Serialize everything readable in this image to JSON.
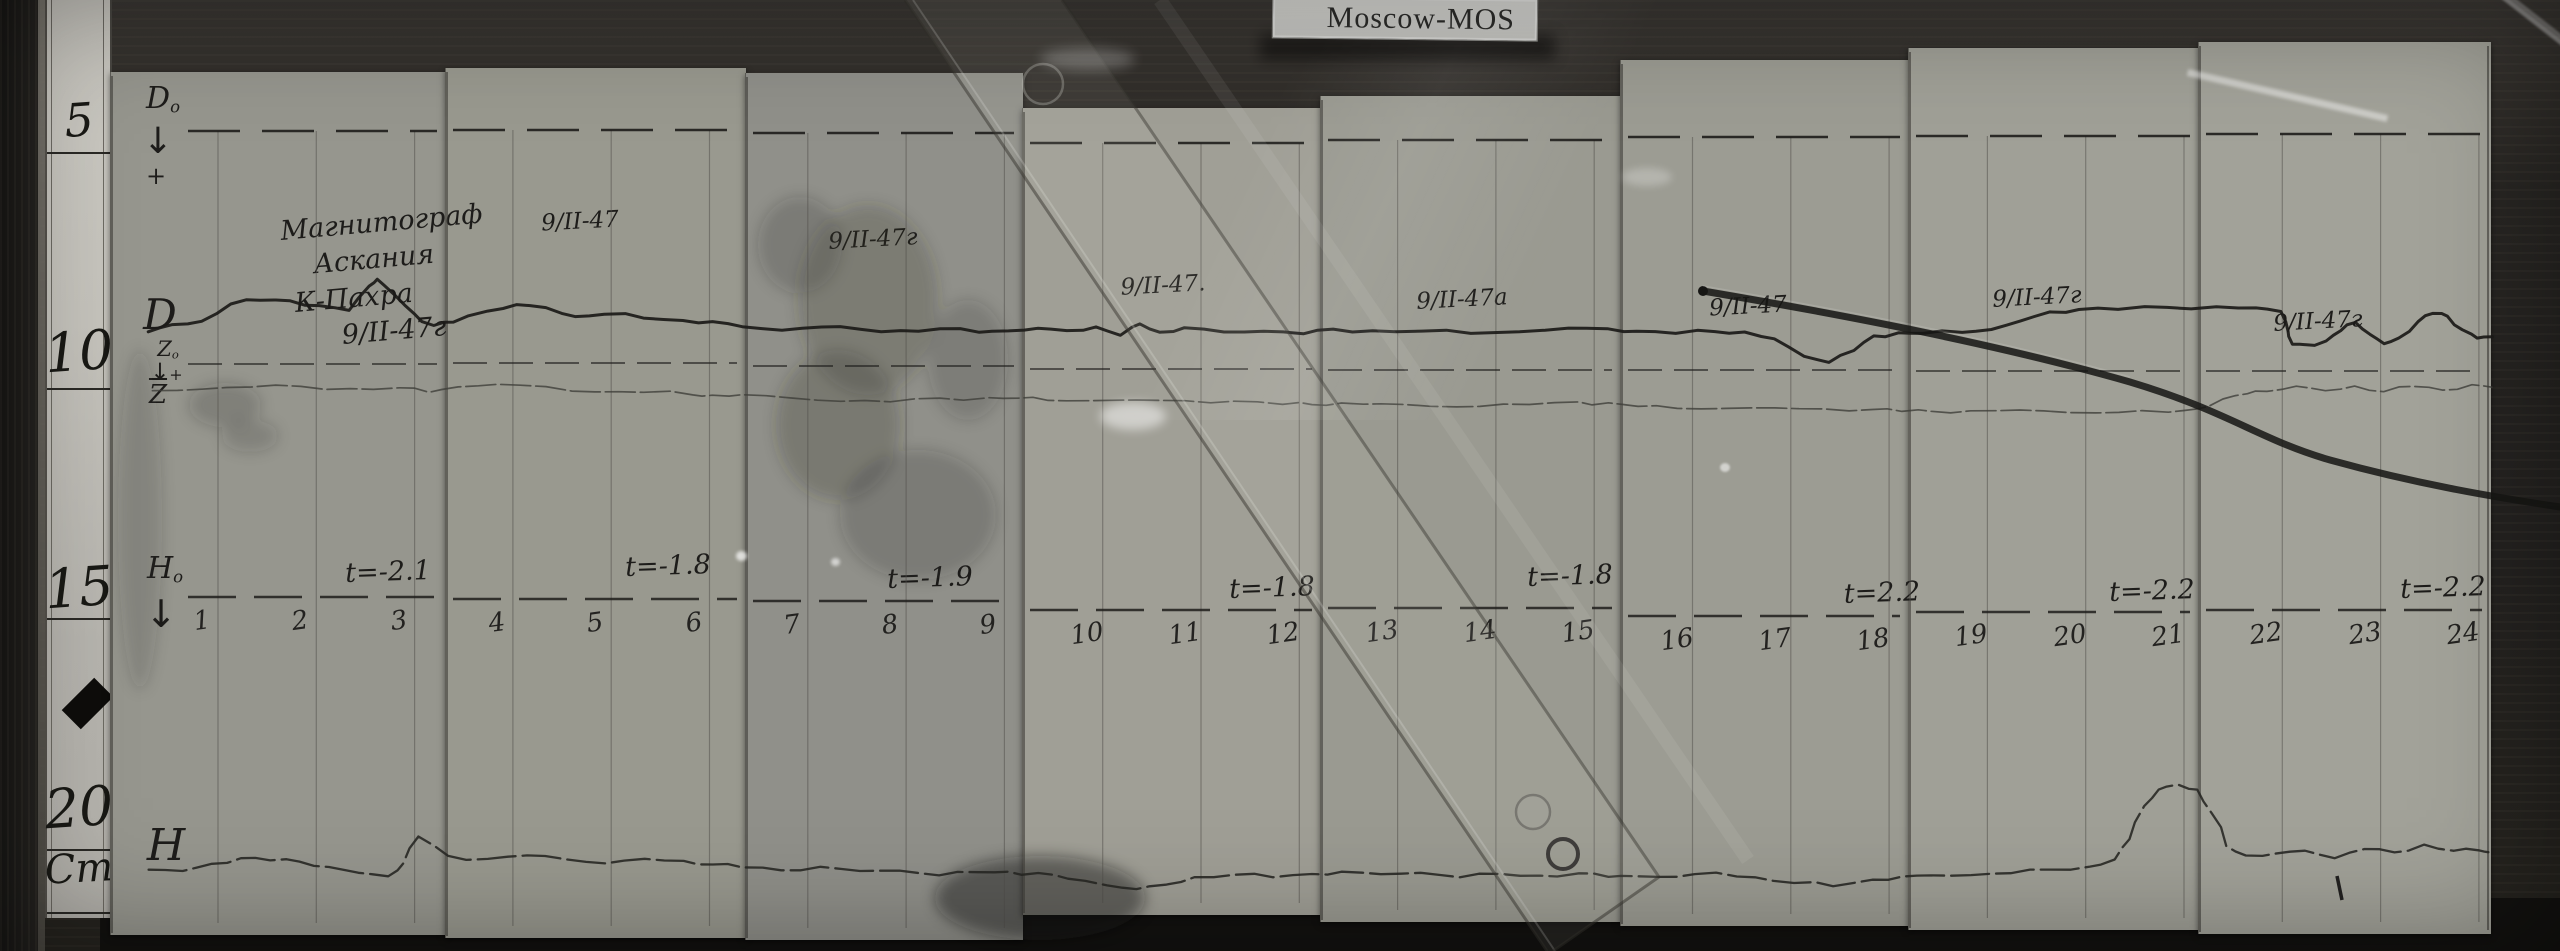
{
  "station_label": "Moscow-MOS",
  "ruler": {
    "marks": [
      "5",
      "10",
      "15",
      "20"
    ],
    "unit": "Cm"
  },
  "header_block": {
    "lines": [
      "Магнитограф",
      "Аскания",
      "К-Пахра",
      "9/II-47г"
    ]
  },
  "trace_labels": {
    "d_baseline": {
      "main": "D",
      "sub": "o"
    },
    "d_arrow": "↓",
    "d_plus": "+",
    "d": "D",
    "z_baseline": {
      "main": "Z",
      "sub": "o"
    },
    "z_arrow": "↓",
    "z_plus": "+",
    "z": "Z",
    "h_baseline": {
      "main": "H",
      "sub": "o"
    },
    "h_arrow": "↓",
    "h": "H"
  },
  "panels": [
    {
      "date": "",
      "t": "t=-2.1",
      "hours": [
        "1",
        "2",
        "3"
      ]
    },
    {
      "date": "9/II-47",
      "t": "t=-1.8",
      "hours": [
        "4",
        "5",
        "6"
      ]
    },
    {
      "date": "9/II-47г",
      "t": "t=-1.9",
      "hours": [
        "7",
        "8",
        "9"
      ]
    },
    {
      "date": "9/II-47.",
      "t": "t=-1.8",
      "hours": [
        "10",
        "11",
        "12"
      ]
    },
    {
      "date": "9/II-47а",
      "t": "t=-1.8",
      "hours": [
        "13",
        "14",
        "15"
      ]
    },
    {
      "date": "9/II-47",
      "t": "t=2.2",
      "hours": [
        "16",
        "17",
        "18"
      ]
    },
    {
      "date": "9/II-47г",
      "t": "t=-2.2",
      "hours": [
        "19",
        "20",
        "21"
      ]
    },
    {
      "date": "9/II-47г",
      "t": "t=-2.2",
      "hours": [
        "22",
        "23",
        "24"
      ]
    }
  ],
  "colors": {
    "paper": "#9b9b93",
    "ink": "#1d1c1a",
    "wood": "#262421",
    "card": "#d6d6d2"
  },
  "chart_data": {
    "type": "line",
    "title": "Moscow-MOS magnetogram, 9/II-1947 (photographed paper record)",
    "x_unit": "hour of day",
    "x_range": [
      0.45,
      24.3
    ],
    "xlabel": "hours 1–24 marked along H₀ baseline",
    "value_note": "y values are vertical photo pixel positions (larger = lower on paper); traces are analog pen records relative to dashed baselines D₀ (y≈132), Z₀ (y≈367), H₀ (y≈605)",
    "temperature_annotations": [
      "t=-2.1",
      "t=-1.8",
      "t=-1.9",
      "t=-1.8",
      "t=-1.8",
      "t=2.2",
      "t=-2.2",
      "t=-2.2"
    ],
    "series": [
      {
        "name": "D",
        "points": [
          [
            0.45,
            332
          ],
          [
            0.7,
            326
          ],
          [
            1,
            322
          ],
          [
            1.3,
            303
          ],
          [
            1.6,
            299
          ],
          [
            1.9,
            301
          ],
          [
            2.2,
            307
          ],
          [
            2.5,
            311
          ],
          [
            2.7,
            285
          ],
          [
            2.78,
            278
          ],
          [
            2.95,
            295
          ],
          [
            3.15,
            315
          ],
          [
            3.35,
            326
          ],
          [
            3.55,
            321
          ],
          [
            3.9,
            310
          ],
          [
            4.2,
            305
          ],
          [
            4.5,
            309
          ],
          [
            4.8,
            317
          ],
          [
            5.1,
            313
          ],
          [
            5.5,
            317
          ],
          [
            5.9,
            321
          ],
          [
            6.2,
            323
          ],
          [
            6.5,
            327
          ],
          [
            6.9,
            329
          ],
          [
            7.3,
            326
          ],
          [
            7.7,
            330
          ],
          [
            8.1,
            332
          ],
          [
            8.5,
            329
          ],
          [
            8.9,
            331
          ],
          [
            9.2,
            330
          ],
          [
            9.5,
            329
          ],
          [
            9.8,
            332
          ],
          [
            10.1,
            327
          ],
          [
            10.35,
            334
          ],
          [
            10.55,
            323
          ],
          [
            10.75,
            333
          ],
          [
            11,
            329
          ],
          [
            11.4,
            332
          ],
          [
            11.8,
            330
          ],
          [
            12.2,
            333
          ],
          [
            12.5,
            330
          ],
          [
            12.9,
            332
          ],
          [
            13.4,
            331
          ],
          [
            13.9,
            332
          ],
          [
            14.4,
            331
          ],
          [
            14.9,
            329
          ],
          [
            15.3,
            330
          ],
          [
            15.6,
            331
          ],
          [
            16,
            332
          ],
          [
            16.4,
            331
          ],
          [
            16.7,
            333
          ],
          [
            17,
            340
          ],
          [
            17.3,
            356
          ],
          [
            17.55,
            361
          ],
          [
            17.8,
            350
          ],
          [
            18,
            337
          ],
          [
            18.25,
            334
          ],
          [
            18.5,
            333
          ],
          [
            18.9,
            331
          ],
          [
            19.2,
            329
          ],
          [
            19.5,
            322
          ],
          [
            19.8,
            313
          ],
          [
            20.1,
            309
          ],
          [
            20.5,
            308
          ],
          [
            21,
            307
          ],
          [
            21.5,
            308
          ],
          [
            21.9,
            309
          ],
          [
            22.15,
            311
          ],
          [
            22.22,
            330
          ],
          [
            22.26,
            344
          ],
          [
            22.4,
            346
          ],
          [
            22.6,
            342
          ],
          [
            22.75,
            330
          ],
          [
            22.9,
            321
          ],
          [
            23.05,
            334
          ],
          [
            23.2,
            345
          ],
          [
            23.35,
            339
          ],
          [
            23.55,
            321
          ],
          [
            23.7,
            312
          ],
          [
            23.85,
            316
          ],
          [
            24,
            331
          ],
          [
            24.15,
            339
          ],
          [
            24.3,
            336
          ]
        ]
      },
      {
        "name": "Z",
        "points": [
          [
            0.5,
            391
          ],
          [
            1,
            388
          ],
          [
            1.5,
            386
          ],
          [
            2,
            387
          ],
          [
            2.5,
            390
          ],
          [
            3,
            388
          ],
          [
            3.3,
            391
          ],
          [
            3.6,
            386
          ],
          [
            4,
            385
          ],
          [
            4.5,
            388
          ],
          [
            5,
            392
          ],
          [
            5.5,
            391
          ],
          [
            6,
            394
          ],
          [
            6.2,
            396
          ],
          [
            6.5,
            396
          ],
          [
            7,
            398
          ],
          [
            7.5,
            400
          ],
          [
            8,
            401
          ],
          [
            8.5,
            399
          ],
          [
            9,
            399
          ],
          [
            9.3,
            398
          ],
          [
            9.6,
            399
          ],
          [
            10,
            400
          ],
          [
            10.5,
            401
          ],
          [
            11,
            402
          ],
          [
            11.5,
            401
          ],
          [
            12,
            403
          ],
          [
            12.3,
            404
          ],
          [
            12.6,
            404
          ],
          [
            13,
            405
          ],
          [
            13.5,
            406
          ],
          [
            14,
            405
          ],
          [
            14.5,
            404
          ],
          [
            15,
            403
          ],
          [
            15.3,
            404
          ],
          [
            15.6,
            406
          ],
          [
            16,
            407
          ],
          [
            16.5,
            408
          ],
          [
            17,
            409
          ],
          [
            17.5,
            410
          ],
          [
            18,
            409
          ],
          [
            18.3,
            410
          ],
          [
            18.6,
            411
          ],
          [
            19,
            412
          ],
          [
            19.5,
            411
          ],
          [
            20,
            412
          ],
          [
            20.5,
            411
          ],
          [
            21,
            412
          ],
          [
            21.3,
            410
          ],
          [
            21.55,
            400
          ],
          [
            21.8,
            393
          ],
          [
            22,
            390
          ],
          [
            22.3,
            386
          ],
          [
            22.6,
            392
          ],
          [
            22.9,
            387
          ],
          [
            23.2,
            391
          ],
          [
            23.5,
            385
          ],
          [
            23.8,
            390
          ],
          [
            24.1,
            386
          ],
          [
            24.3,
            388
          ]
        ]
      },
      {
        "name": "H",
        "points": [
          [
            0.45,
            869
          ],
          [
            0.8,
            872
          ],
          [
            1.1,
            865
          ],
          [
            1.4,
            858
          ],
          [
            1.7,
            859
          ],
          [
            2,
            861
          ],
          [
            2.3,
            868
          ],
          [
            2.6,
            874
          ],
          [
            2.9,
            876
          ],
          [
            3.05,
            862
          ],
          [
            3.2,
            836
          ],
          [
            3.5,
            857
          ],
          [
            3.9,
            860
          ],
          [
            4.3,
            855
          ],
          [
            4.7,
            858
          ],
          [
            5.1,
            863
          ],
          [
            5.5,
            860
          ],
          [
            5.9,
            862
          ],
          [
            6.2,
            864
          ],
          [
            6.5,
            866
          ],
          [
            6.9,
            870
          ],
          [
            7.3,
            868
          ],
          [
            7.7,
            872
          ],
          [
            8.1,
            870
          ],
          [
            8.5,
            874
          ],
          [
            8.9,
            872
          ],
          [
            9.2,
            873
          ],
          [
            9.5,
            874
          ],
          [
            9.8,
            878
          ],
          [
            10.2,
            884
          ],
          [
            10.5,
            889
          ],
          [
            10.8,
            886
          ],
          [
            11.1,
            878
          ],
          [
            11.5,
            874
          ],
          [
            11.9,
            876
          ],
          [
            12.3,
            874
          ],
          [
            12.6,
            873
          ],
          [
            13,
            875
          ],
          [
            13.4,
            872
          ],
          [
            13.8,
            876
          ],
          [
            14.2,
            874
          ],
          [
            14.6,
            877
          ],
          [
            15,
            874
          ],
          [
            15.3,
            876
          ],
          [
            15.6,
            875
          ],
          [
            16,
            877
          ],
          [
            16.4,
            874
          ],
          [
            16.8,
            878
          ],
          [
            17.2,
            882
          ],
          [
            17.6,
            885
          ],
          [
            18,
            880
          ],
          [
            18.3,
            878
          ],
          [
            18.6,
            876
          ],
          [
            19,
            874
          ],
          [
            19.4,
            872
          ],
          [
            19.8,
            870
          ],
          [
            20.2,
            868
          ],
          [
            20.45,
            860
          ],
          [
            20.6,
            838
          ],
          [
            20.75,
            805
          ],
          [
            20.9,
            790
          ],
          [
            21.1,
            786
          ],
          [
            21.3,
            790
          ],
          [
            21.45,
            812
          ],
          [
            21.6,
            845
          ],
          [
            21.8,
            856
          ],
          [
            22.1,
            855
          ],
          [
            22.4,
            851
          ],
          [
            22.7,
            857
          ],
          [
            23,
            848
          ],
          [
            23.3,
            853
          ],
          [
            23.6,
            846
          ],
          [
            23.9,
            851
          ],
          [
            24.15,
            849
          ],
          [
            24.3,
            852
          ]
        ]
      }
    ],
    "legend_position": "handwritten labels at left margin",
    "grid": "vertical hour lines on 8 pasted strips of 3 hours each"
  }
}
